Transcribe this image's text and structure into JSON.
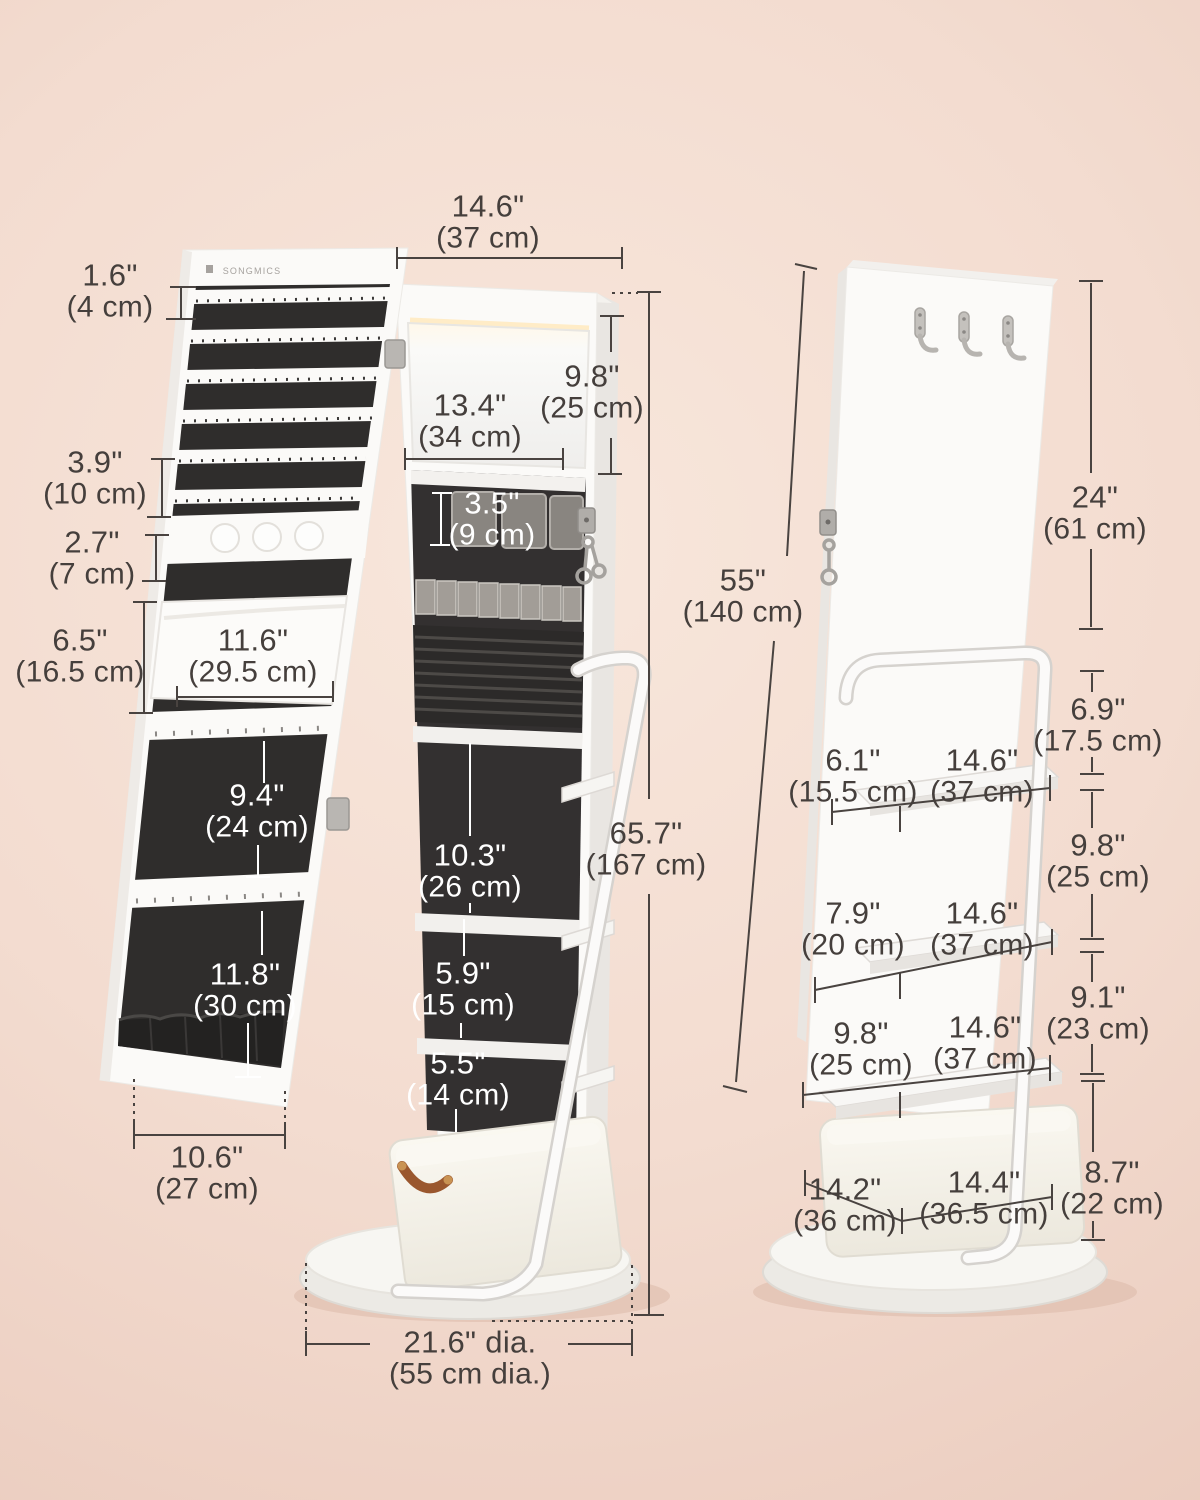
{
  "brand": {
    "logo": "SONGMICS"
  },
  "colors": {
    "background_center": "#f8e7dc",
    "background_edge": "#e9c9bb",
    "dimension_text": "#453f3c",
    "dimension_text_light": "#ffffff",
    "dimension_line": "#494340",
    "cabinet_white": "#fbfaf8",
    "felt_black": "#2f2d2c",
    "basket_fabric": "#f4f1e9",
    "leather_handle": "#9a572e",
    "metal_silver": "#b7b4b0"
  },
  "dims": {
    "door_slot_spacing": {
      "in": "1.6\"",
      "cm": "(4 cm)"
    },
    "cabinet_width": {
      "in": "14.6\"",
      "cm": "(37 cm)"
    },
    "mirror_height": {
      "in": "9.8\"",
      "cm": "(25 cm)"
    },
    "mirror_width": {
      "in": "13.4\"",
      "cm": "(34 cm)"
    },
    "door_hook_clearance": {
      "in": "3.9\"",
      "cm": "(10 cm)"
    },
    "door_hook_row_height": {
      "in": "2.7\"",
      "cm": "(7 cm)"
    },
    "tray_height": {
      "in": "3.5\"",
      "cm": "(9 cm)"
    },
    "door_pocket_height": {
      "in": "6.5\"",
      "cm": "(16.5 cm)"
    },
    "door_pocket_width": {
      "in": "11.6\"",
      "cm": "(29.5 cm)"
    },
    "door_lower_panel_1_height": {
      "in": "9.4\"",
      "cm": "(24 cm)"
    },
    "interior_section_1_height": {
      "in": "10.3\"",
      "cm": "(26 cm)"
    },
    "total_height": {
      "in": "65.7\"",
      "cm": "(167 cm)"
    },
    "door_lower_panel_2_height": {
      "in": "11.8\"",
      "cm": "(30 cm)"
    },
    "interior_section_2_height": {
      "in": "5.9\"",
      "cm": "(15 cm)"
    },
    "interior_section_3_height": {
      "in": "5.5\"",
      "cm": "(14 cm)"
    },
    "door_width": {
      "in": "10.6\"",
      "cm": "(27 cm)"
    },
    "base_diameter": {
      "in": "21.6\" dia.",
      "cm": "(55 cm dia.)"
    },
    "back_panel_height": {
      "in": "55\"",
      "cm": "(140 cm)"
    },
    "top_to_handle_height": {
      "in": "24\"",
      "cm": "(61 cm)"
    },
    "handle_to_shelf_gap": {
      "in": "6.9\"",
      "cm": "(17.5 cm)"
    },
    "shelf_1_depth": {
      "in": "6.1\"",
      "cm": "(15.5 cm)"
    },
    "shelf_1_width": {
      "in": "14.6\"",
      "cm": "(37 cm)"
    },
    "shelf_1_to_2_gap": {
      "in": "9.8\"",
      "cm": "(25 cm)"
    },
    "shelf_2_depth": {
      "in": "7.9\"",
      "cm": "(20 cm)"
    },
    "shelf_2_width": {
      "in": "14.6\"",
      "cm": "(37 cm)"
    },
    "shelf_2_to_3_gap": {
      "in": "9.1\"",
      "cm": "(23 cm)"
    },
    "shelf_3_depth": {
      "in": "9.8\"",
      "cm": "(25 cm)"
    },
    "shelf_3_width": {
      "in": "14.6\"",
      "cm": "(37 cm)"
    },
    "basket_depth": {
      "in": "14.2\"",
      "cm": "(36 cm)"
    },
    "basket_width": {
      "in": "14.4\"",
      "cm": "(36.5 cm)"
    },
    "basket_height": {
      "in": "8.7\"",
      "cm": "(22 cm)"
    }
  }
}
